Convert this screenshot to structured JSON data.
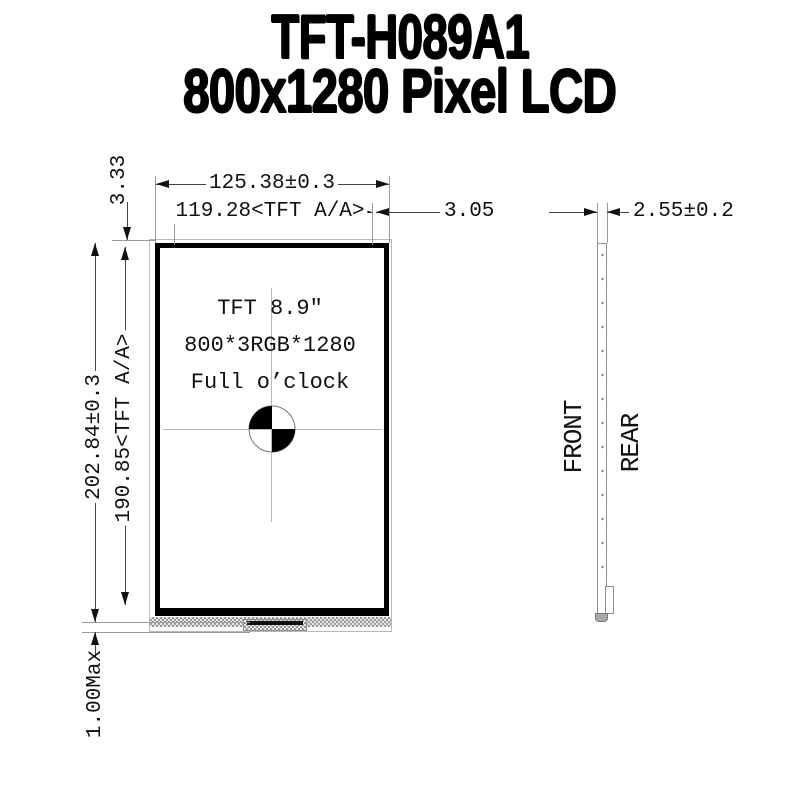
{
  "colors": {
    "ink": "#000000",
    "dimension_line": "#444444",
    "extension_line": "#9a9a9a",
    "background": "#ffffff"
  },
  "title": {
    "line1": "TFT-H089A1",
    "line2": "800x1280 Pixel LCD"
  },
  "front_view": {
    "display_text": {
      "line1": "TFT 8.9″",
      "line2": "800*3RGB*1280",
      "line3": "Full o’clock"
    },
    "dimensions": {
      "outer_width": "125.38±0.3",
      "active_width": "119.28<TFT A/A>",
      "right_border": "3.05",
      "top_border": "3.33",
      "outer_height": "202.84±0.3",
      "active_height": "190.85<TFT A/A>",
      "bottom_protrusion": "1.00Max"
    }
  },
  "side_view": {
    "dimensions": {
      "thickness": "2.55±0.2"
    },
    "labels": {
      "front": "FRONT",
      "rear": "REAR"
    }
  }
}
